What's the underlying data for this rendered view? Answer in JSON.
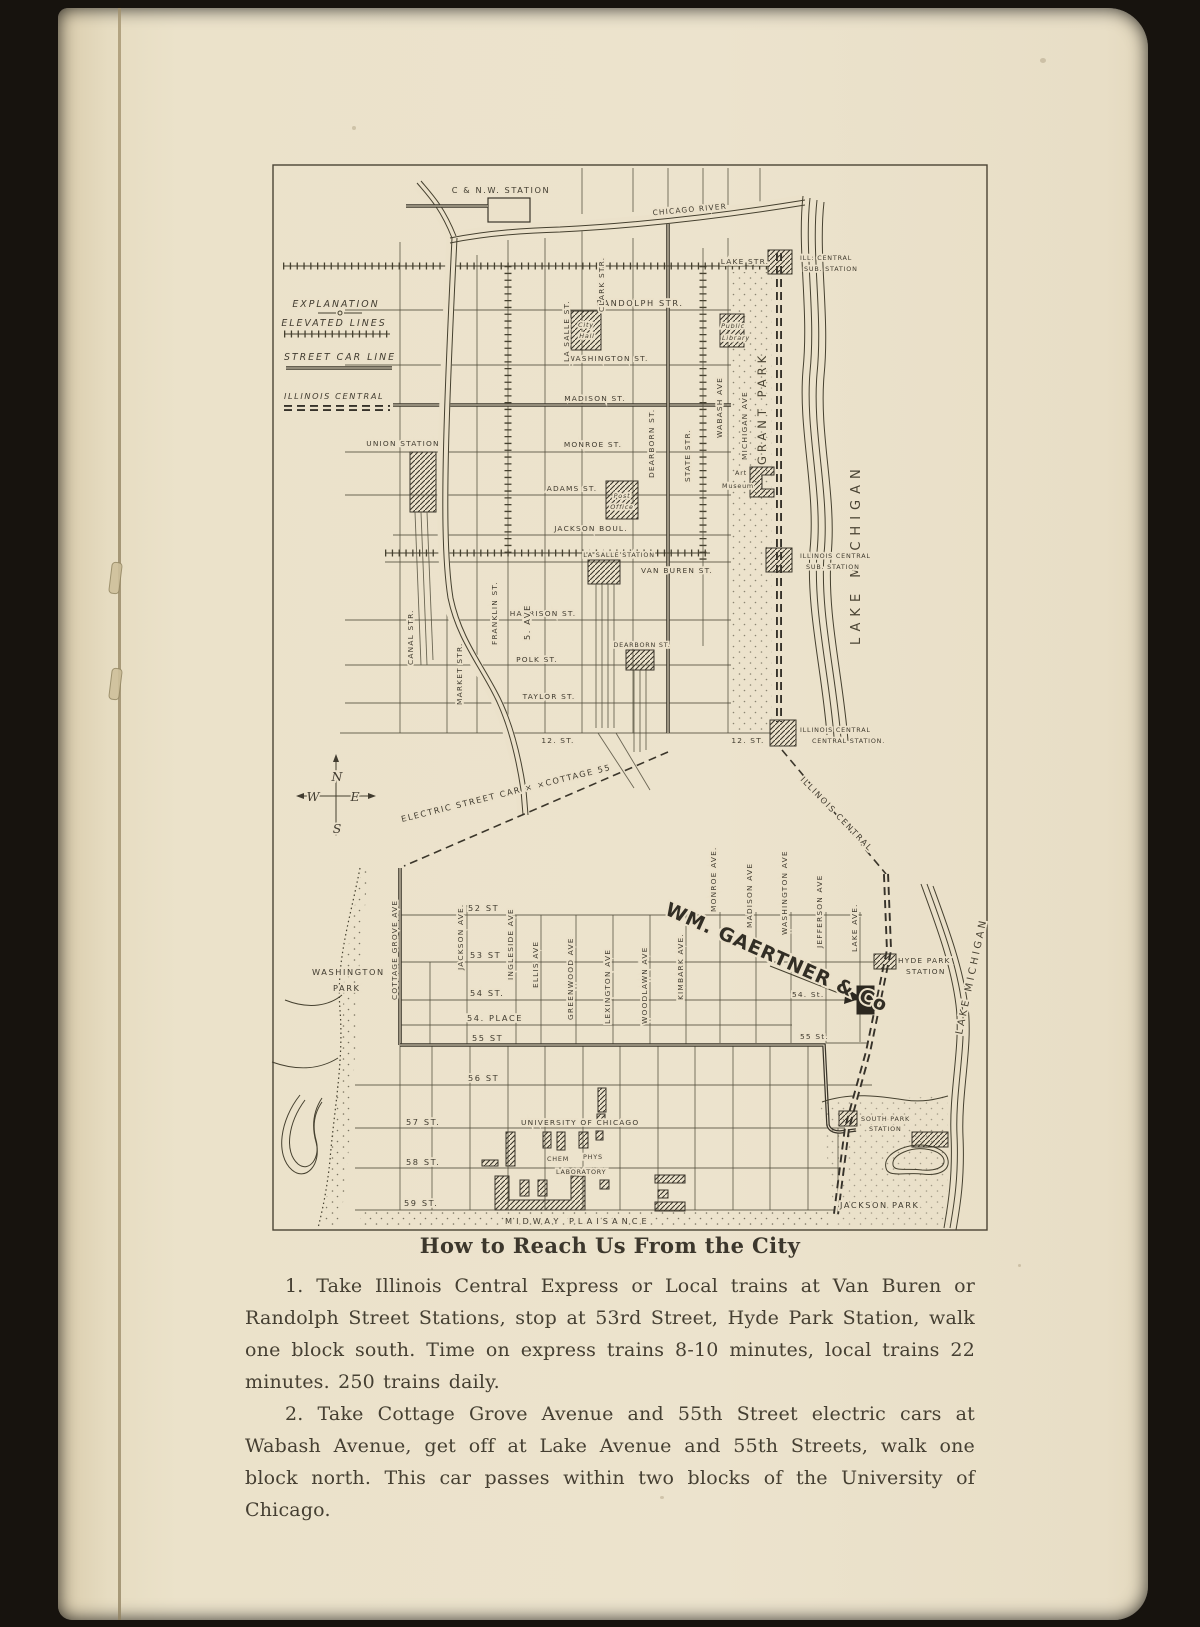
{
  "colors": {
    "page_background": "#ebe2ca",
    "ink": "#413c30",
    "surround": "#17130e"
  },
  "heading": "How to Reach Us From the City",
  "paragraphs": {
    "p1": "1.  Take Illinois Central Express or Local trains at Van Buren or Randolph Street Stations, stop at 53rd Street, Hyde Park Station, walk one block south. Time on express trains 8-10 minutes, local trains 22 minutes.  250 trains daily.",
    "p2": "2.  Take Cottage Grove Avenue and 55th Street electric cars at Wabash Avenue, get off at Lake Avenue and 55th Streets, walk one block north.  This car passes within two blocks of the University of Chicago."
  },
  "legend": {
    "title": "EXPLANATION",
    "elevated": "ELEVATED LINES",
    "street_car": "STREET CAR LINE",
    "illinois_central": "ILLINOIS CENTRAL"
  },
  "compass": {
    "n": "N",
    "e": "E",
    "s": "S",
    "w": "W"
  },
  "top_map": {
    "cnw_station": "C & N.W. STATION",
    "chicago_river": "CHICAGO RIVER",
    "lake_michigan": "LAKE MICHIGAN",
    "grant_park": "GRANT PARK",
    "twelfth_right": "12. ST.",
    "streets_ew": {
      "lake": "LAKE STR.",
      "randolph": "RANDOLPH STR.",
      "washington": "WASHINGTON ST.",
      "madison": "MADISON ST.",
      "monroe": "MONROE ST.",
      "adams": "ADAMS ST.",
      "jackson": "JACKSON BOUL.",
      "van_buren": "VAN BUREN ST.",
      "harrison": "HARRISON ST.",
      "polk": "POLK ST.",
      "taylor": "TAYLOR ST.",
      "twelfth": "12. ST."
    },
    "streets_ns": {
      "canal": "CANAL STR.",
      "market": "MARKET STR.",
      "franklin": "FRANKLIN ST.",
      "fifth": "5. AVE",
      "lasalle": "LA SALLE ST.",
      "clark": "CLARK STR.",
      "dearborn": "DEARBORN ST.",
      "state": "STATE STR.",
      "wabash": "WABASH AVE",
      "michigan": "MICHIGAN AVE"
    },
    "stations": {
      "union": "UNION STATION",
      "lasalle": "LA SALLE STATION",
      "dearborn": "DEARBORN ST.",
      "ic_sub_north_1": "ILL: CENTRAL",
      "ic_sub_north_2": "SUB. STATION",
      "ic_sub_south_1": "ILLINOIS CENTRAL",
      "ic_sub_south_2": "SUB. STATION",
      "ic_central_1": "ILLINOIS CENTRAL",
      "ic_central_2": "CENTRAL STATION."
    },
    "buildings": {
      "city_hall_1": "City",
      "city_hall_2": "Hall",
      "library_1": "Public",
      "library_2": "Library",
      "post_1": "Post",
      "post_2": "Office",
      "museum_1": "Art",
      "museum_2": "Museum"
    }
  },
  "connector": {
    "electric_car": "ELECTRIC STREET CAR × ×COTTAGE 55",
    "illinois_central": "ILLINOIS CENTRAL"
  },
  "bottom_map": {
    "gaertner": "WM. GAERTNER & Co",
    "washington_park_1": "WASHINGTON",
    "washington_park_2": "PARK",
    "jackson_park": "JACKSON PARK",
    "midway": "MIDWAY PLAISANCE",
    "lake_michigan": "LAKE MICHIGAN",
    "avenues": {
      "cottage_grove": "COTTAGE GROVE AVE",
      "jackson": "JACKSON AVE.",
      "ingleside": "INGLESIDE AVE",
      "ellis": "ELLIS AVE",
      "greenwood": "GREENWOOD AVE",
      "lexington": "LEXINGTON AVE",
      "woodlawn": "WOODLAWN AVE",
      "kimbark": "KIMBARK AVE.",
      "monroe": "MONROE AVE.",
      "madison": "MADISON AVE",
      "washington": "WASHINGTON AVE",
      "jefferson": "JEFFERSON AVE",
      "lake": "LAKE AVE."
    },
    "streets": {
      "s52": "52 ST",
      "s53": "53 ST",
      "s54": "54 ST.",
      "p54": "54. PLACE",
      "s55": "55 ST",
      "s54r": "54. St.",
      "s55r": "55 St.",
      "s56": "56 ST",
      "s57": "57 ST.",
      "s58": "58 ST.",
      "s59": "59 ST."
    },
    "stations": {
      "hyde_park_1": "HYDE PARK",
      "hyde_park_2": "STATION",
      "south_park_1": "SOUTH PARK",
      "south_park_2": "STATION"
    },
    "university": {
      "name": "UNIVERSITY OF CHICAGO",
      "chem": "CHEM",
      "phys": "PHYS",
      "laboratory": "LABORATORY"
    }
  }
}
